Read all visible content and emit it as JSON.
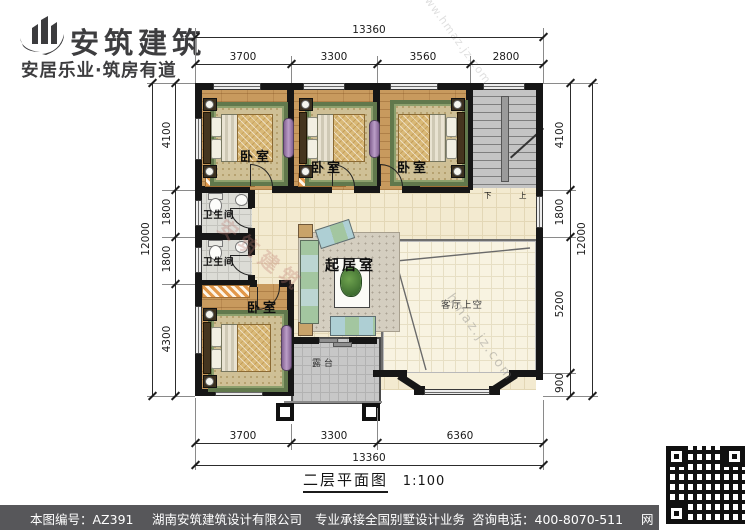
{
  "brand": {
    "name": "安筑建筑",
    "tagline": "安居乐业·筑房有道"
  },
  "plan": {
    "title": "二层平面图",
    "scale": "1:100",
    "rooms": {
      "bedroom": "卧室",
      "bathroom": "卫生间",
      "living": "起居室",
      "void": "客厅上空",
      "terrace": "露台",
      "stair_down": "下",
      "stair_up": "上"
    },
    "dims": {
      "top": {
        "total": "13360",
        "segments": [
          "3700",
          "3300",
          "3560",
          "2800"
        ]
      },
      "left": {
        "total": "12000",
        "segments": [
          "4100",
          "1800",
          "1800",
          "4300"
        ]
      },
      "right": {
        "total": "12000",
        "segments": [
          "4100",
          "1800",
          "5200",
          "900"
        ]
      },
      "bottom": {
        "total": "13360",
        "segments": [
          "3700",
          "3300",
          "6360"
        ]
      }
    }
  },
  "watermarks": {
    "brand_diag": "安筑建筑",
    "site1": "hmaz.jz.com",
    "site2": "www.hmaz.jz.com"
  },
  "footer": {
    "drawing_no": "本图编号：AZ391",
    "company": "湖南安筑建筑设计有限公司",
    "service": "专业承接全国别墅设计业务",
    "phone": "咨询电话：400-8070-511",
    "web_char": "网"
  },
  "colors": {
    "wall": "#161616",
    "wood_floor": "#c89a5e",
    "footer_bar": "#57575a",
    "accent_purple": "#8f6d9e",
    "rug_green": "#61784c"
  }
}
